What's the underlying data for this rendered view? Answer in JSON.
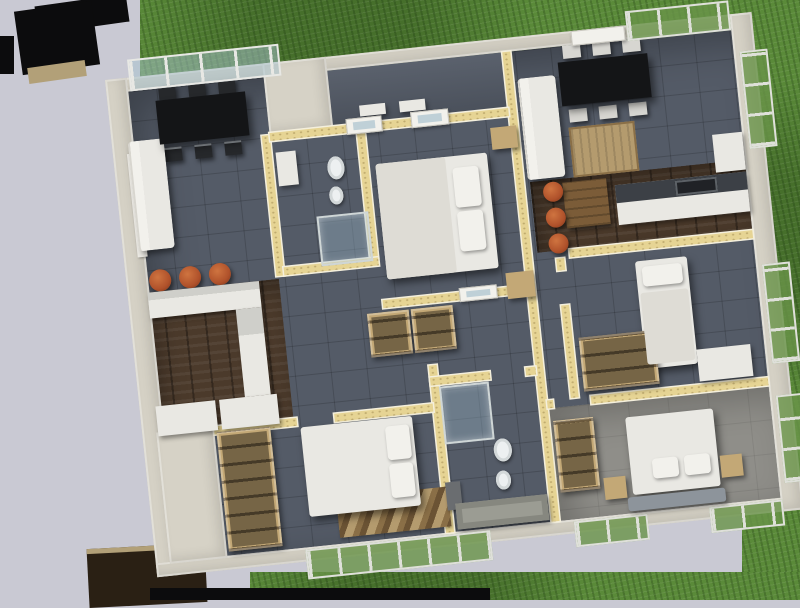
{
  "scene": {
    "type": "3d-floor-plan-render",
    "view": "top-down cutaway of a duplex apartment, slightly rotated, surrounded by grass on top/right/bottom and a lavender backdrop on the left, with black roof fragments at the top-left and bottom-left",
    "units": [
      {
        "name": "left-apartment",
        "rooms": [
          {
            "name": "living-dining-left",
            "floor": "dark-slate-tile",
            "furniture": [
              "black-dining-table",
              "six-dark-chairs",
              "white-sofa",
              "glazed-window-wall-top",
              "window-left"
            ]
          },
          {
            "name": "kitchen-left",
            "floor": "dark-wood",
            "furniture": [
              "l-shaped-white-counter",
              "three-rust-bar-stools",
              "white-base-cabinets"
            ]
          },
          {
            "name": "bathroom-left",
            "floor": "dark-slate-tile",
            "furniture": [
              "washbasin",
              "toilet",
              "bidet",
              "glass-shower"
            ]
          },
          {
            "name": "bedroom-center",
            "floor": "dark-slate-tile",
            "furniture": [
              "double-bed-white",
              "two-pillows",
              "two-tan-nightstands"
            ]
          },
          {
            "name": "hallway-left",
            "floor": "dark-slate-tile",
            "furniture": [
              "two-tan-built-in-wardrobes",
              "glazed-interior-doors"
            ]
          },
          {
            "name": "bedroom-bottom-left",
            "floor": "dark-slate-tile",
            "furniture": [
              "double-bed-white",
              "tan-open-wardrobe",
              "striped-rug",
              "window-wall-bottom"
            ]
          },
          {
            "name": "bathroom-bottom-center",
            "floor": "dark-slate-tile",
            "furniture": [
              "glass-shower",
              "toilet",
              "bidet",
              "gray-bathtub",
              "gray-washbasin"
            ]
          }
        ]
      },
      {
        "name": "right-apartment",
        "rooms": [
          {
            "name": "entry-terrace",
            "floor": "dark-slate-tile",
            "furniture": [
              "step-pads",
              "glazed-entry-doors"
            ]
          },
          {
            "name": "living-dining-right",
            "floor": "dark-slate-tile",
            "furniture": [
              "black-dining-table",
              "six-light-chairs",
              "white-sofa",
              "tan-rug",
              "door-top",
              "window-top"
            ]
          },
          {
            "name": "kitchen-right",
            "floor": "dark-wood",
            "furniture": [
              "counter-with-dark-worktop",
              "built-in-oven",
              "wood-breakfast-table",
              "three-rust-chairs",
              "tall-white-cabinet"
            ]
          },
          {
            "name": "bedroom-right",
            "floor": "dark-slate-tile",
            "furniture": [
              "single-bed-white",
              "tan-wardrobe",
              "white-desk",
              "window-right"
            ]
          },
          {
            "name": "bedroom-bottom-right",
            "floor": "light-screed",
            "furniture": [
              "double-bed-white",
              "two-pillows",
              "two-tan-nightstands",
              "gray-bench",
              "tan-open-shelf",
              "window-right"
            ]
          }
        ]
      }
    ]
  },
  "colors": {
    "bg": "#c9c9d3",
    "grass": "#5a8a39",
    "grass-dark": "#466f2b",
    "slate": "#545b67",
    "wood": "#4b3a2b",
    "light-floor": "#8f8e89",
    "wall-yellow": "#e6d494",
    "wall-edge": "#f4efdc",
    "ext": "#d6d2c6",
    "white-furn": "#e9e8e3",
    "white-soft": "#f2f1ec",
    "tan": "#c3a876",
    "rust": "#b0522b",
    "black-furn": "#141517",
    "chair-dark": "#26282b",
    "chair-light": "#d7d6d1",
    "glass-green": "#6f9a4e",
    "roof-black": "#0c0c0d",
    "roof-tan": "#b2a078",
    "roof-brown": "#2a2014",
    "rug-a": "#b49b6e",
    "rug-b": "#6b5334",
    "tub-gray": "#9b9c93",
    "bench-gray": "#8d949b",
    "counter-dark": "#3c4046",
    "porcelain": "#edf0f1"
  }
}
